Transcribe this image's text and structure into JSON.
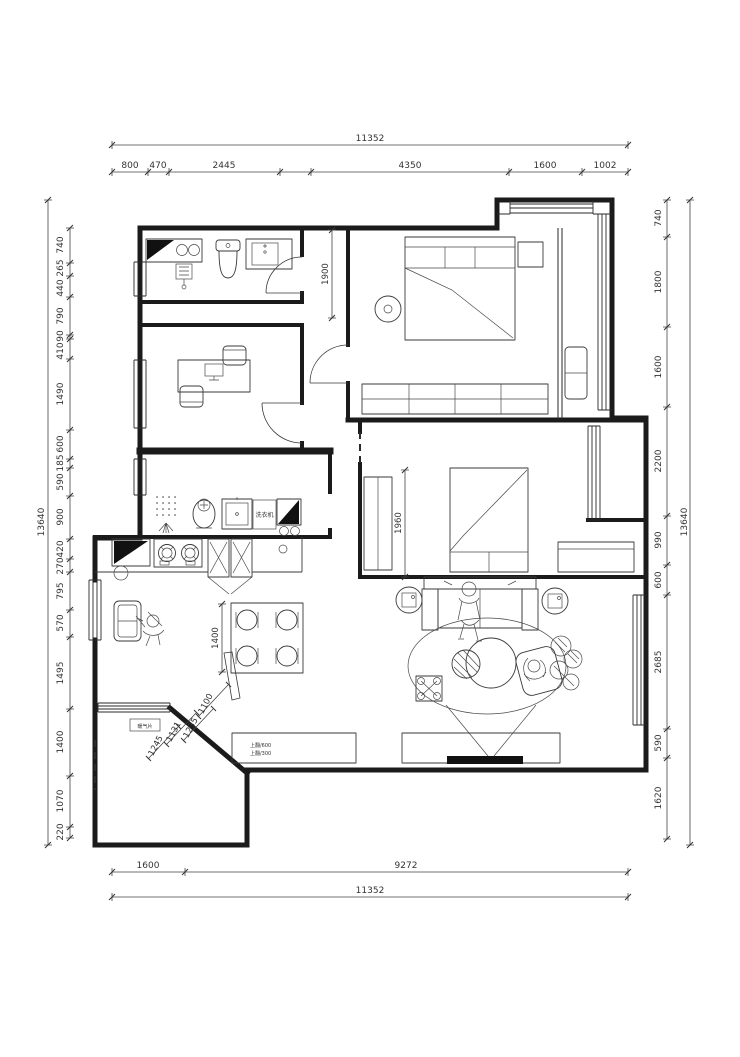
{
  "drawing": {
    "type": "residential floor plan",
    "units": "mm",
    "dims": {
      "top": {
        "overall": "11352",
        "segments": [
          "800",
          "470",
          "2445",
          "4350",
          "1600",
          "1002"
        ]
      },
      "bottom": {
        "overall": "11352",
        "segments": [
          "1600",
          "9272"
        ]
      },
      "left": {
        "overall": "13640",
        "segments": [
          "740",
          "265",
          "440",
          "790",
          "90",
          "410",
          "1490",
          "600",
          "185",
          "590",
          "900",
          "420",
          "270",
          "795",
          "570",
          "1495",
          "1400",
          "1070",
          "220"
        ]
      },
      "right": {
        "overall": "13640",
        "segments": [
          "740",
          "1800",
          "1600",
          "2200",
          "990",
          "600",
          "2685",
          "590",
          "1620"
        ]
      },
      "interior": {
        "hall_depth": "1900",
        "bed2_clearance": "1960",
        "dining_width": "1400",
        "entry_widths": [
          "1245",
          "1131",
          "1235",
          "1100"
        ]
      }
    },
    "annotations": {
      "washing_machine": "洗衣机",
      "radiator": "暖气片",
      "flip_cabinet_top": "上翻/600",
      "flip_cabinet_bottom": "上翻/300"
    }
  }
}
